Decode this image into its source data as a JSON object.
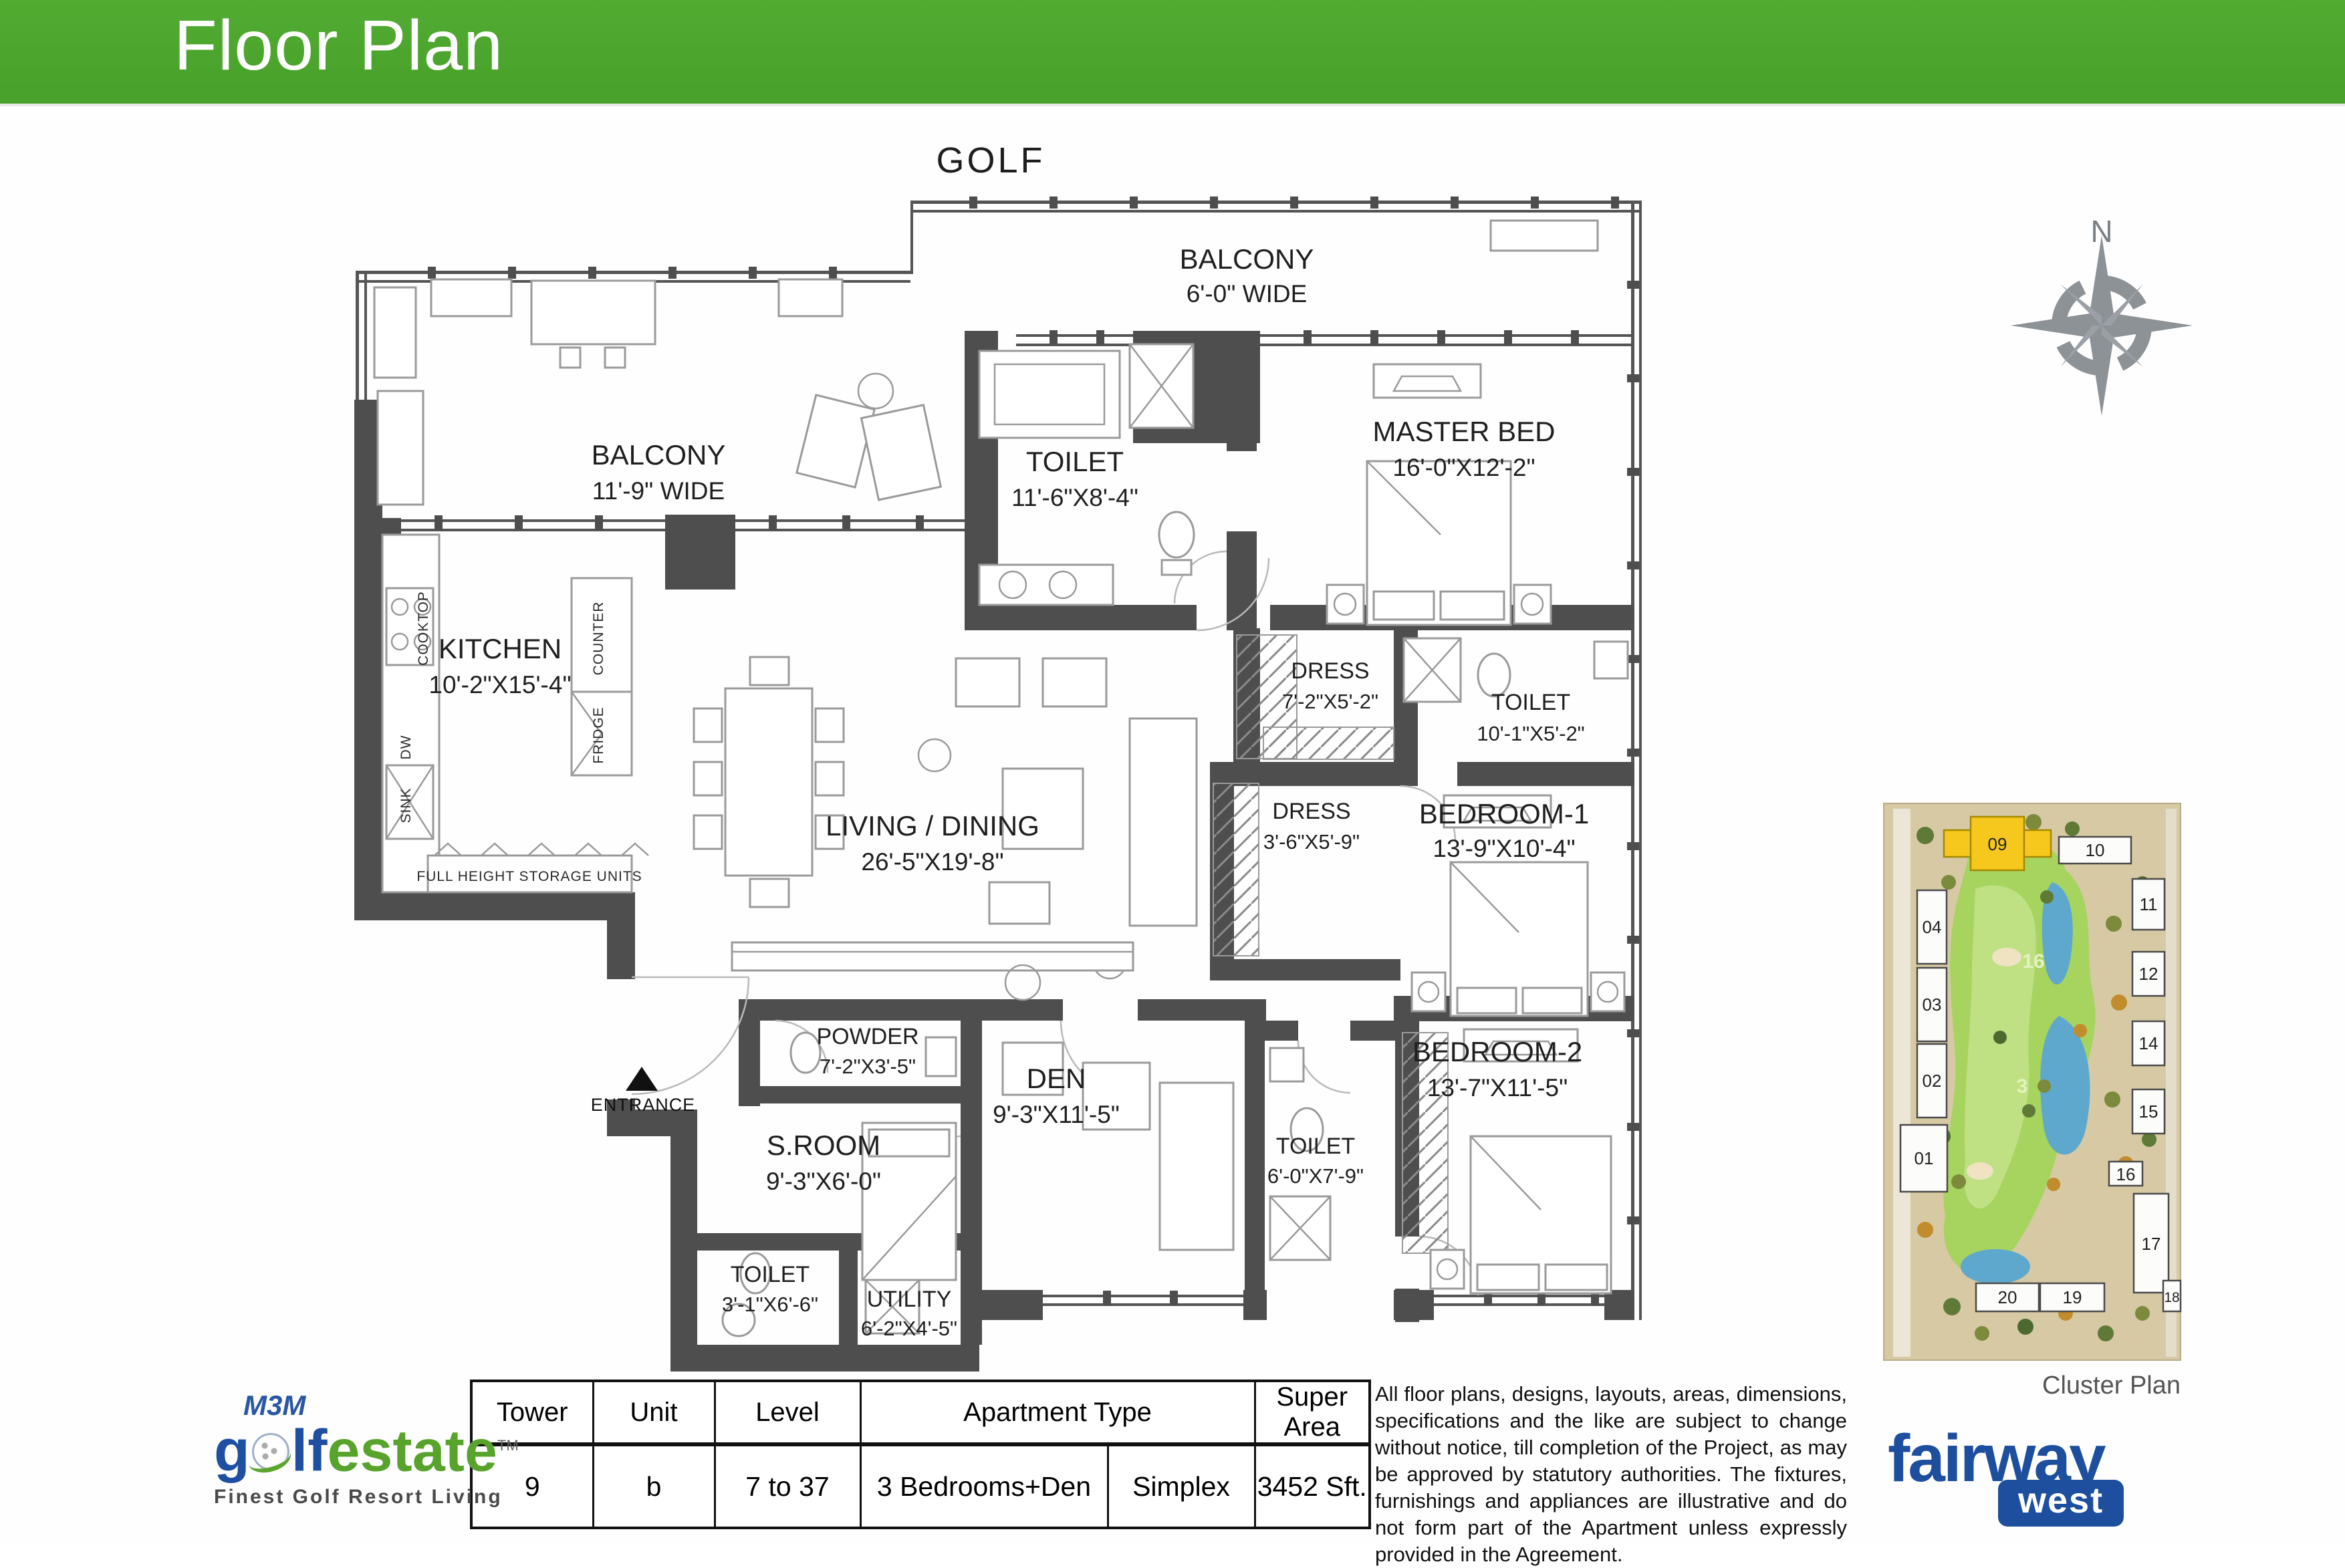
{
  "header": {
    "title": "Floor Plan"
  },
  "plan": {
    "golf_label": "GOLF",
    "compass_label": "N",
    "entrance_label": "ENTRANCE",
    "rooms": [
      {
        "name": "BALCONY",
        "dims": "6'-0\" WIDE"
      },
      {
        "name": "BALCONY",
        "dims": "11'-9\" WIDE"
      },
      {
        "name": "TOILET",
        "dims": "11'-6\"X8'-4\""
      },
      {
        "name": "MASTER BED",
        "dims": "16'-0\"X12'-2\""
      },
      {
        "name": "KITCHEN",
        "dims": "10'-2\"X15'-4\""
      },
      {
        "name": "LIVING / DINING",
        "dims": "26'-5\"X19'-8\""
      },
      {
        "name": "DRESS",
        "dims": "7'-2\"X5'-2\""
      },
      {
        "name": "TOILET",
        "dims": "10'-1\"X5'-2\""
      },
      {
        "name": "DRESS",
        "dims": "3'-6\"X5'-9\""
      },
      {
        "name": "BEDROOM-1",
        "dims": "13'-9\"X10'-4\""
      },
      {
        "name": "POWDER",
        "dims": "7'-2\"X3'-5\""
      },
      {
        "name": "DEN",
        "dims": "9'-3\"X11'-5\""
      },
      {
        "name": "S.ROOM",
        "dims": "9'-3\"X6'-0\""
      },
      {
        "name": "TOILET",
        "dims": "3'-1\"X6'-6\""
      },
      {
        "name": "UTILITY",
        "dims": "6'-2\"X4'-5\""
      },
      {
        "name": "TOILET",
        "dims": "6'-0\"X7'-9\""
      },
      {
        "name": "BEDROOM-2",
        "dims": "13'-7\"X11'-5\""
      }
    ],
    "kitchen_labels": {
      "cooktop": "COOKTOP",
      "dw": "DW",
      "sink": "SINK",
      "counter": "COUNTER",
      "fridge": "FRIDGE",
      "storage": "FULL HEIGHT STORAGE UNITS"
    }
  },
  "cluster": {
    "caption": "Cluster Plan",
    "highlight_color": "#F6C81D",
    "buildings": [
      "09",
      "10",
      "11",
      "12",
      "14",
      "15",
      "16",
      "17",
      "18",
      "19",
      "20",
      "04",
      "03",
      "02",
      "01"
    ],
    "holes": [
      "16",
      "3"
    ]
  },
  "table": {
    "headers": [
      "Tower",
      "Unit",
      "Level",
      "Apartment Type",
      "Super Area"
    ],
    "row": {
      "tower": "9",
      "unit": "b",
      "level": "7 to 37",
      "apartment_type": "3 Bedrooms+Den",
      "layout": "Simplex",
      "super_area": "3452 Sft."
    }
  },
  "disclaimer": "All floor plans, designs, layouts, areas, dimensions, specifications and the like are subject to change without notice, till completion of the Project, as may be approved by statutory authorities. The fixtures, furnishings and appliances are illustrative and do not form part of the Apartment unless expressly provided in the Agreement.",
  "m3m_logo": {
    "m3m": "M3M",
    "golf_g": "g",
    "golf_lf": "lf",
    "estate": "estate",
    "tm": "TM",
    "tagline": "Finest Golf Resort Living"
  },
  "fairway_logo": {
    "name": "fairway",
    "badge": "west"
  }
}
